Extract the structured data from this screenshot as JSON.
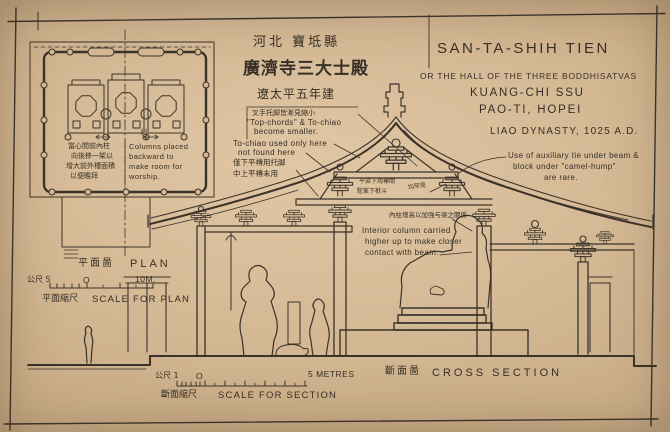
{
  "colors": {
    "paper": "#cfb28e",
    "ink": "#3b332a"
  },
  "header": {
    "cn_region": "河北 寶坻縣",
    "cn_title": "廣濟寺三大士殿",
    "cn_date": "遼太平五年建",
    "en_title": "SAN-TA-SHIH TIEN",
    "en_subtitle": "OR THE HALL OF THE THREE BODDHISATVAS",
    "en_temple": "KUANG-CHI SSU",
    "en_place": "PAO-TI, HOPEI",
    "en_date": "LIAO DYNASTY, 1025 A.D."
  },
  "plan": {
    "label_cn": "平面啚",
    "label_en": "PLAN",
    "scale_left": "公尺 5",
    "scale_zero": "O",
    "scale_right": "10M.",
    "scale_caption_cn": "平面縮尺",
    "scale_caption_en": "SCALE FOR PLAN",
    "note_cn": [
      "當心間前內柱",
      "向後移一架以",
      "增大前外槽面積",
      "以便瞻拜"
    ],
    "note_en": [
      "Columns placed",
      "backward to",
      "make room for",
      "worship."
    ]
  },
  "section": {
    "label_cn": "斷面啚",
    "label_en": "CROSS SECTION",
    "scale_left": "公尺 1",
    "scale_zero": "O",
    "scale_right": "5 METRES",
    "scale_caption_cn": "斷面縮尺",
    "scale_caption_en": "SCALE FOR SECTION",
    "note_chashou_cn": "叉手托脚皆漸見縮小",
    "note_chashou_en": [
      "\"Top-chords\" & To-chiao",
      "become smaller."
    ],
    "note_tochiao": [
      "To-chiao used only here",
      "not found here"
    ],
    "note_purlin_cn": [
      "僅下平槫用托脚",
      "中上平槫未用"
    ],
    "note_tie_cn": [
      "平梁下用襻間",
      "駝峯下栿斗"
    ],
    "note_tie_cn2": "均罕見",
    "note_tie_en": [
      "Use of auxiliary tie under beam &",
      "block under \"camel-hump\"",
      "are rare."
    ],
    "note_column_cn": "內柱增高以加強与梁之關係",
    "note_column_en": [
      "Interior column carried",
      "higher up to make closer",
      "contact with beam."
    ]
  }
}
